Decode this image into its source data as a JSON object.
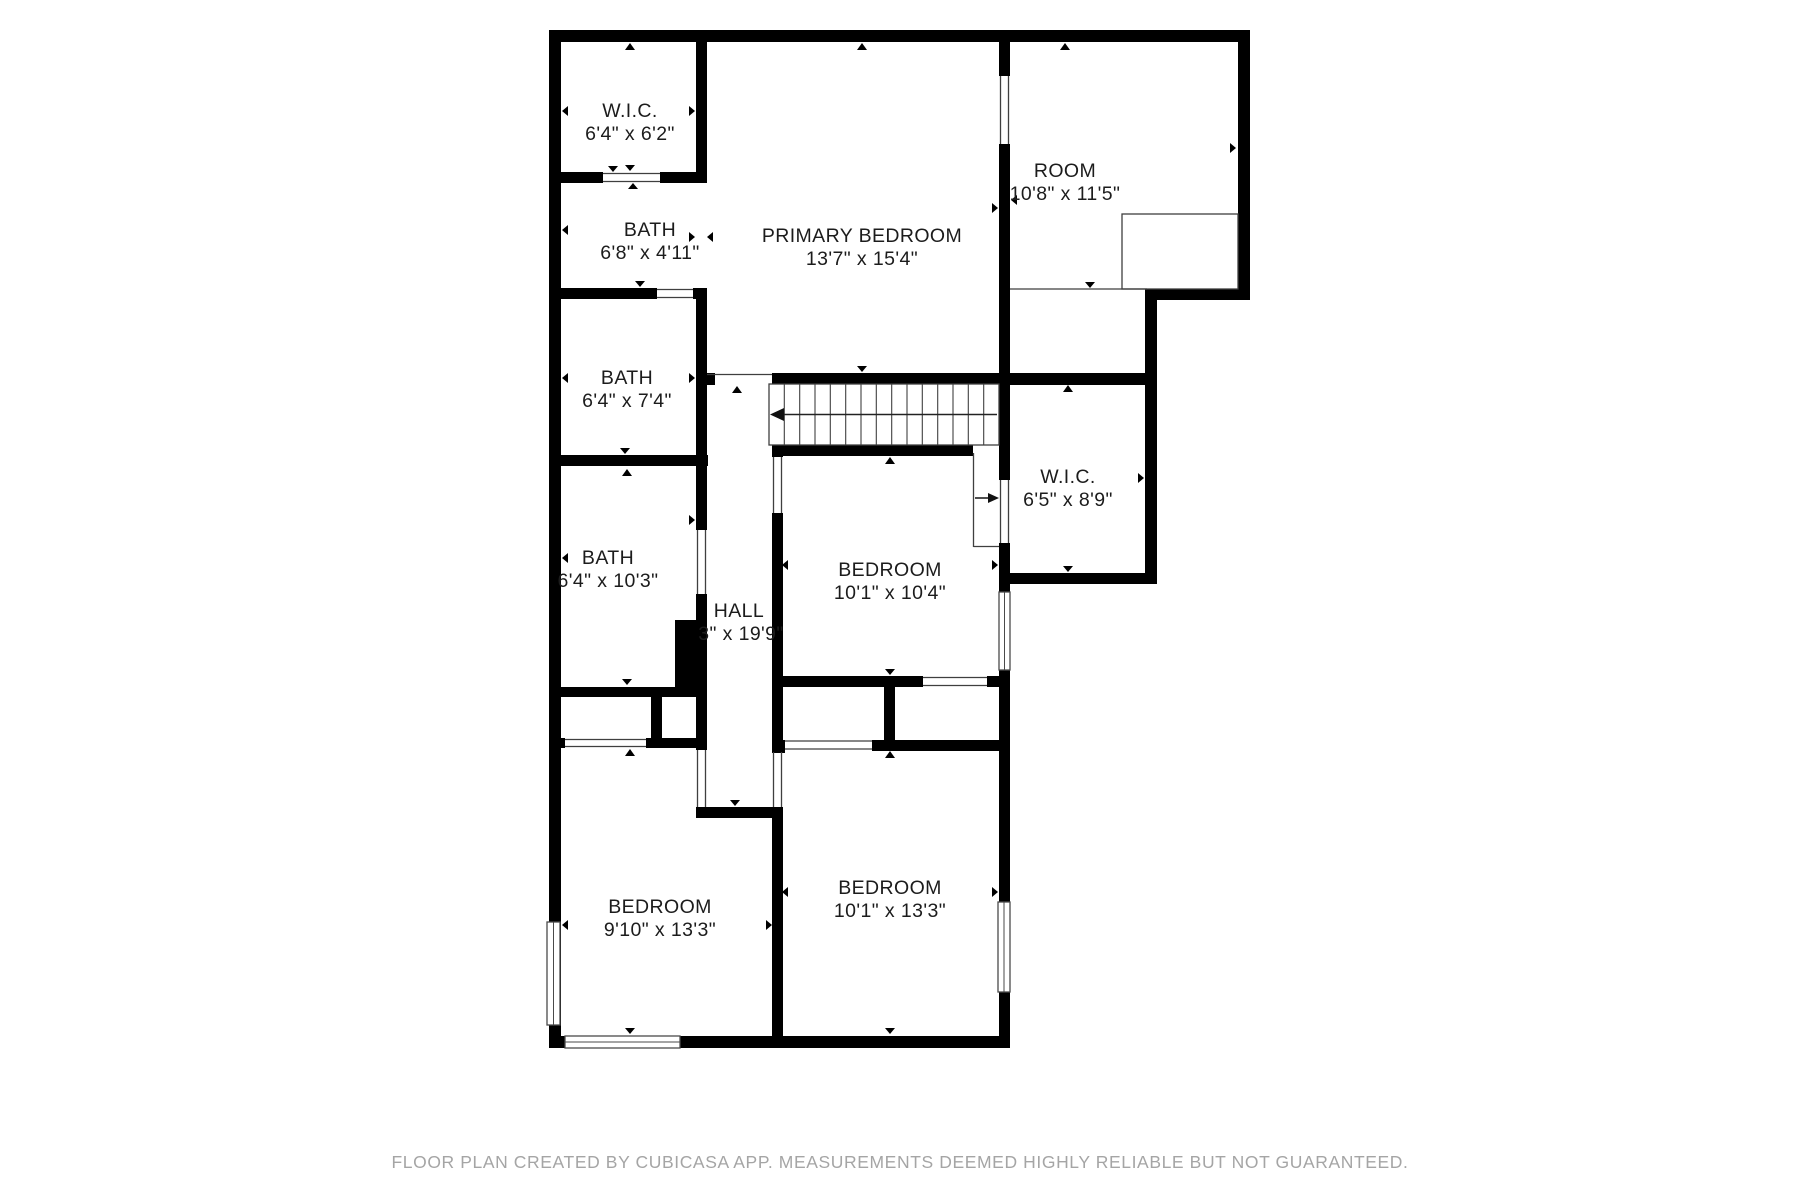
{
  "meta": {
    "app": "CubiCasa floor plan",
    "type": "2D floor plan, upper floor"
  },
  "colors": {
    "wall": "#000000",
    "floor": "#ffffff",
    "thin_line": "#3f3f3f",
    "label_text": "#1c1c1c",
    "footer_text": "#a5a5a5"
  },
  "rooms": [
    {
      "id": "wic-top",
      "name": "W.I.C.",
      "dims": "6'4\" x 6'2\""
    },
    {
      "id": "bath-ensuite",
      "name": "BATH",
      "dims": "6'8\" x 4'11\""
    },
    {
      "id": "bath-middle",
      "name": "BATH",
      "dims": "6'4\" x 7'4\""
    },
    {
      "id": "bath-lower",
      "name": "BATH",
      "dims": "6'4\" x 10'3\""
    },
    {
      "id": "primary-bedroom",
      "name": "PRIMARY BEDROOM",
      "dims": "13'7\" x 15'4\""
    },
    {
      "id": "room",
      "name": "ROOM",
      "dims": "10'8\" x 11'5\""
    },
    {
      "id": "wic-right",
      "name": "W.I.C.",
      "dims": "6'5\" x 8'9\""
    },
    {
      "id": "hall",
      "name": "HALL",
      "dims": "3\" x 19'9\""
    },
    {
      "id": "bedroom-middle",
      "name": "BEDROOM",
      "dims": "10'1\" x 10'4\""
    },
    {
      "id": "bedroom-bottom-left",
      "name": "BEDROOM",
      "dims": "9'10\" x 13'3\""
    },
    {
      "id": "bedroom-bottom-right",
      "name": "BEDROOM",
      "dims": "10'1\" x 13'3\""
    }
  ],
  "footer": {
    "text": "FLOOR PLAN CREATED BY CUBICASA APP. MEASUREMENTS DEEMED HIGHLY RELIABLE BUT NOT GUARANTEED."
  }
}
